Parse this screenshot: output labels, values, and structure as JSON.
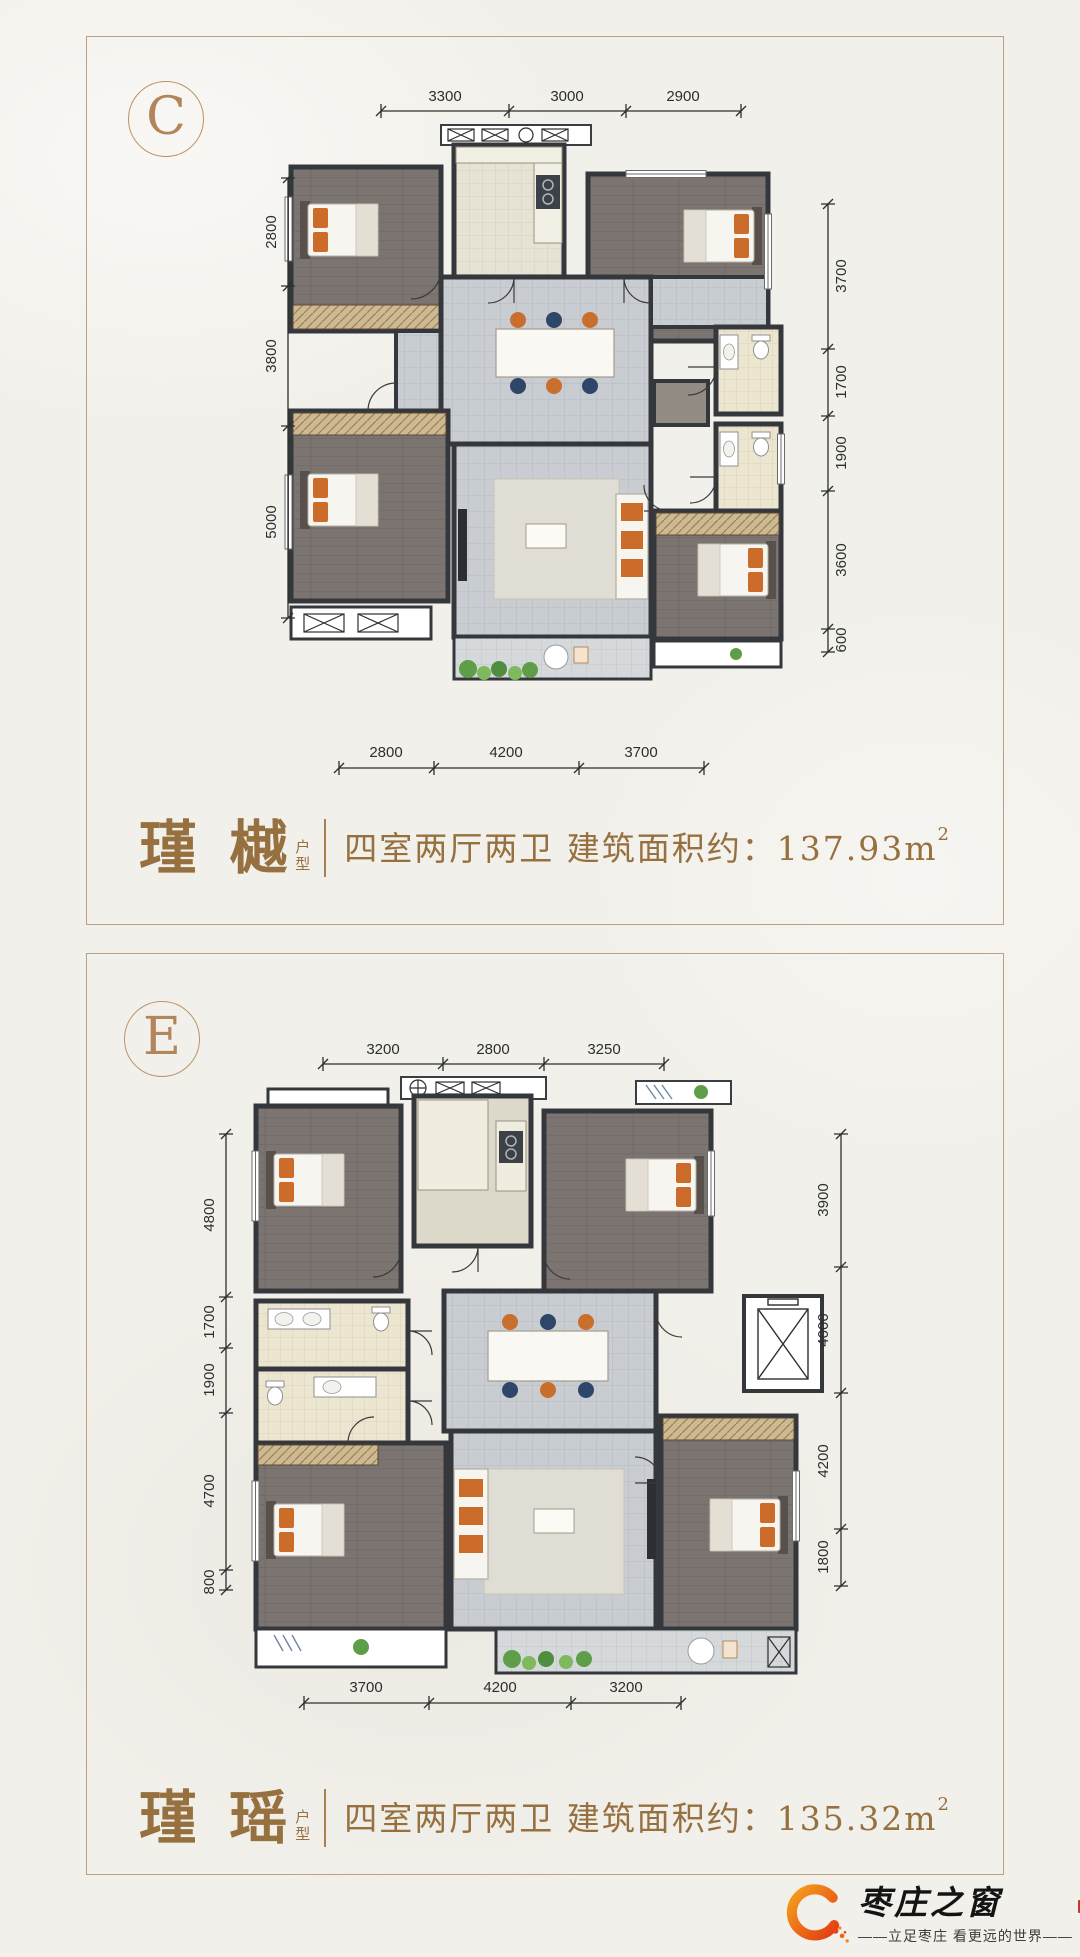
{
  "panels": [
    {
      "letter": "C",
      "name": "瑾 樾",
      "suffix_top": "户",
      "suffix_bottom": "型",
      "desc": "四室两厅两卫  建筑面积约：137.93m",
      "sup": "2",
      "dims": {
        "top": [
          "3300",
          "3000",
          "2900"
        ],
        "left": [
          "2800",
          "3800",
          "5000"
        ],
        "right": [
          "3700",
          "1700",
          "1900",
          "3600",
          "600"
        ],
        "bottom": [
          "2800",
          "4200",
          "3700"
        ]
      }
    },
    {
      "letter": "E",
      "name": "瑾 瑶",
      "suffix_top": "户",
      "suffix_bottom": "型",
      "desc": "四室两厅两卫  建筑面积约：135.32m",
      "sup": "2",
      "dims": {
        "top": [
          "3200",
          "2800",
          "3250"
        ],
        "left": [
          "4800",
          "1700",
          "1900",
          "4700",
          "800"
        ],
        "right": [
          "3900",
          "4000",
          "4200",
          "1800"
        ],
        "bottom": [
          "3700",
          "4200",
          "3200"
        ]
      }
    }
  ],
  "logo": {
    "brand": "枣庄之窗",
    "tagline": "——立足枣庄  看更远的世界——",
    "accent_orange": "#e8521a",
    "accent_bronze": "#96703f",
    "border_color": "#bda081"
  }
}
